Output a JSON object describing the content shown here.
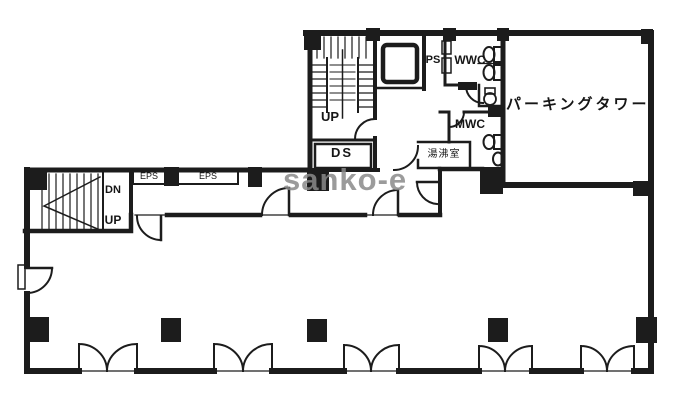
{
  "title": "building-floor-plan",
  "watermark": "sanko-e",
  "rooms": {
    "parking_tower": "パーキングタワー",
    "ds_shaft": "DS",
    "ps_shaft": "PS",
    "womens_wc": "WWC",
    "mens_wc": "MWC",
    "hot_water_room": "湯沸室",
    "eps_shaft_1": "EPS",
    "eps_shaft_2": "EPS"
  },
  "stairs": {
    "center_up": "UP",
    "left_up": "UP",
    "left_down": "DN"
  },
  "colors": {
    "wall": "#1c1c1c",
    "background": "#ffffff",
    "watermark": "#8a8a8a"
  }
}
